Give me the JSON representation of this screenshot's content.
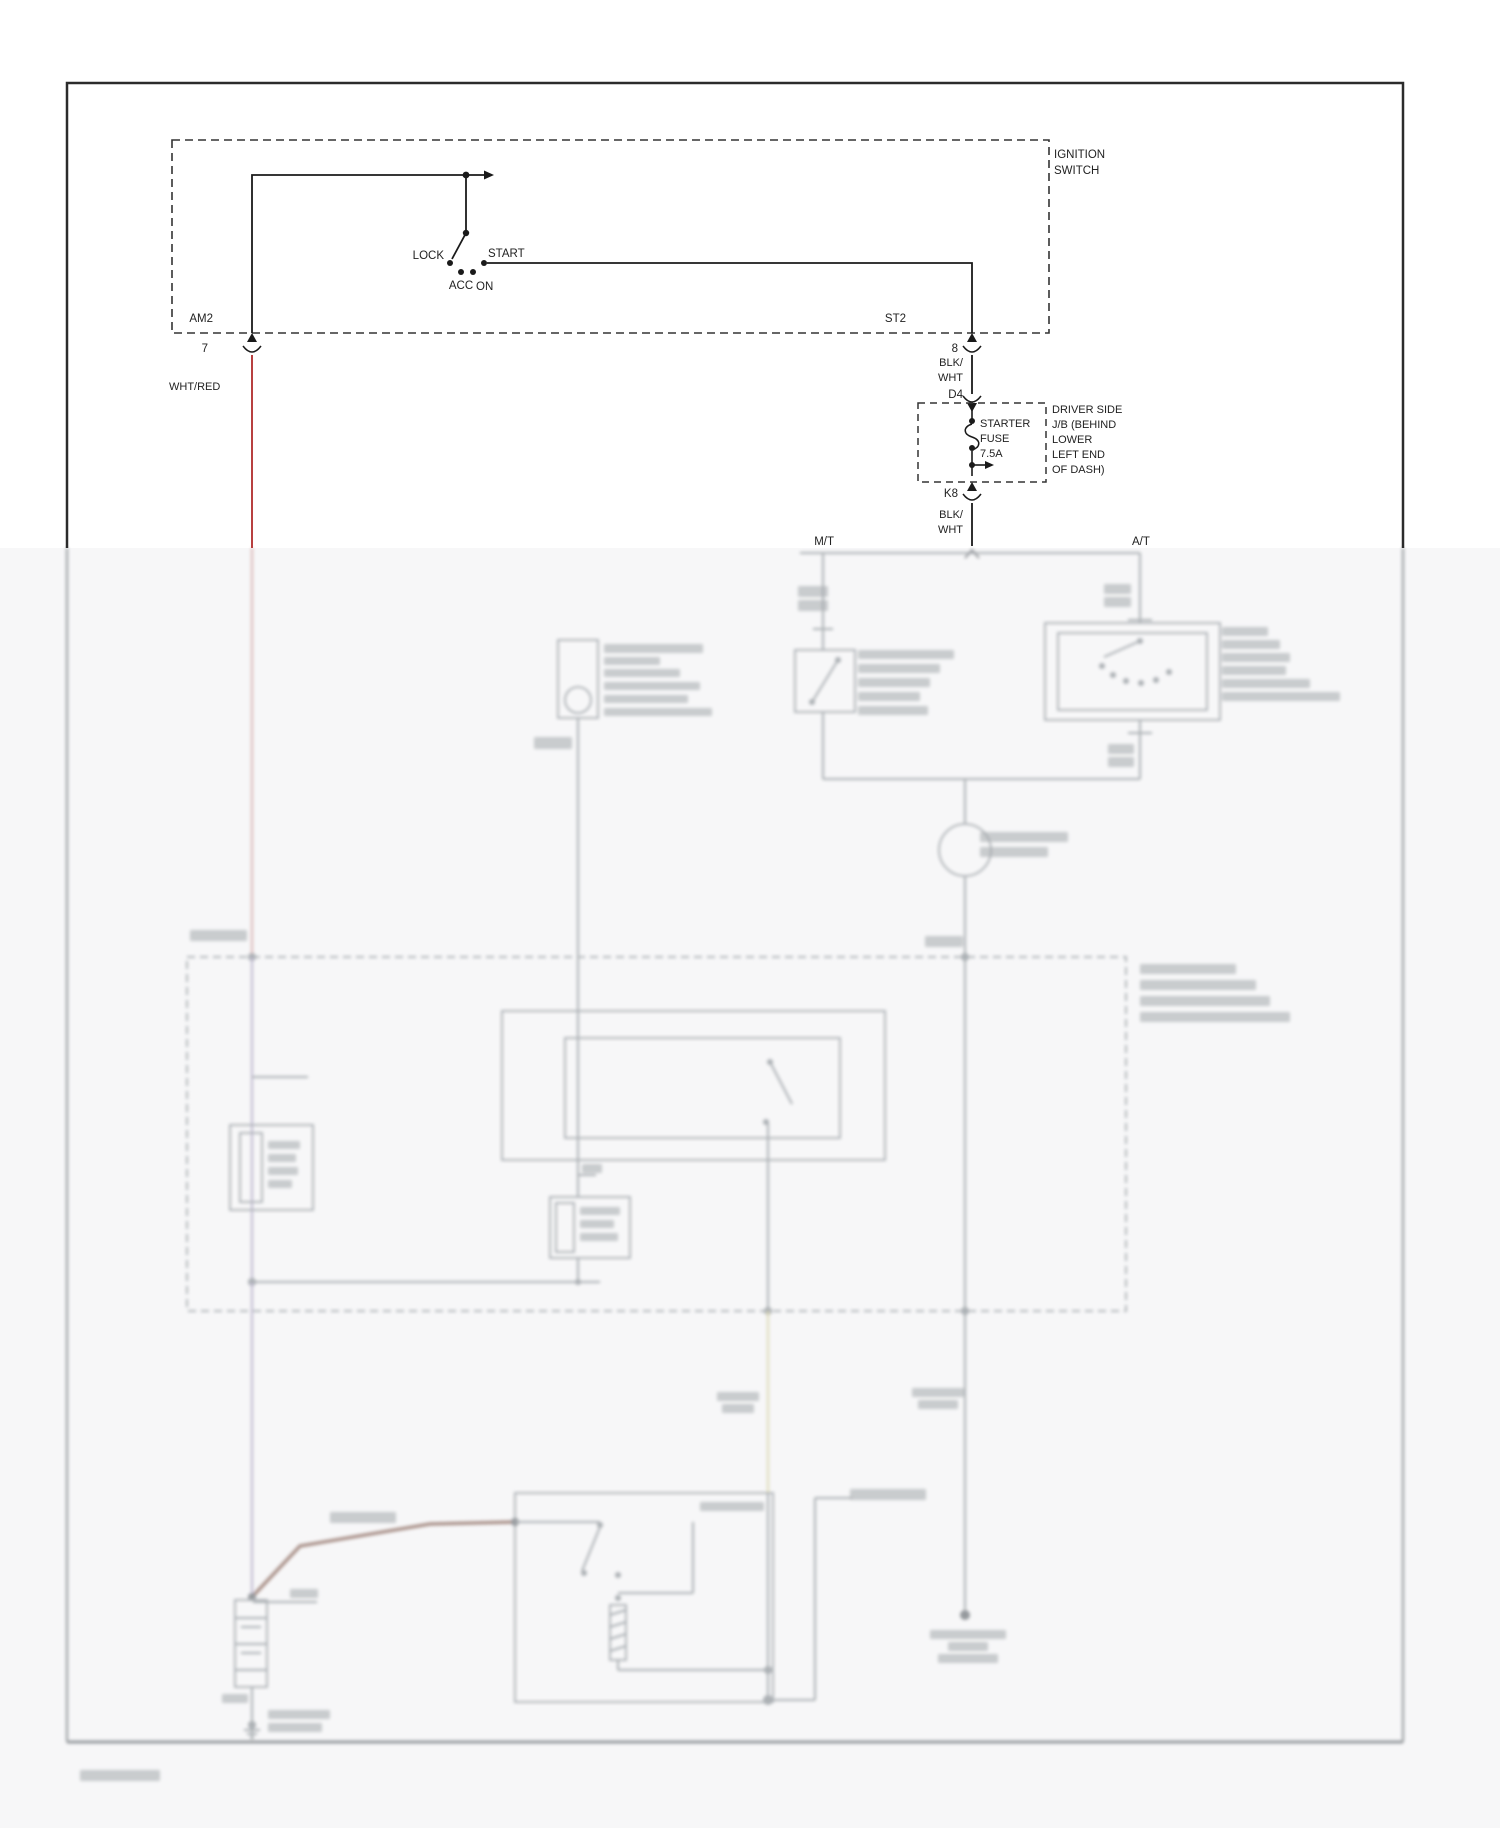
{
  "page": {
    "kind": "wiring-diagram",
    "background": "#ffffff",
    "faded_zone_bg": "#f7f7f8",
    "border_color": "#2b2b2b"
  },
  "diagram": {
    "accent_wire_red": "#b84040",
    "labels": {
      "ignition_line1": "IGNITION",
      "ignition_line2": "SWITCH",
      "lock": "LOCK",
      "acc": "ACC",
      "on": "ON",
      "start": "START",
      "am2": "AM2",
      "pin7": "7",
      "wht_red": "WHT/RED",
      "st2": "ST2",
      "pin8": "8",
      "blk1a": "BLK/",
      "blk1b": "WHT",
      "d4": "D4",
      "fuse_line1": "STARTER",
      "fuse_line2": "FUSE",
      "fuse_line3": "7.5A",
      "jb_line1": "DRIVER SIDE",
      "jb_line2": "J/B (BEHIND",
      "jb_line3": "LOWER",
      "jb_line4": "LEFT END",
      "jb_line5": "OF DASH)",
      "k8": "K8",
      "blk2a": "BLK/",
      "blk2b": "WHT",
      "mt": "M/T",
      "at": "A/T"
    }
  },
  "faded_sketch": {
    "base_stroke": "#7f868c",
    "bar_fill": "#6f767c",
    "colors": {
      "pink": "#c98f8f",
      "lav": "#9b92b5",
      "yel": "#cfc98f",
      "brown": "#7d564a",
      "dark": "#5a6066"
    },
    "items": [
      {
        "t": "l",
        "x1": 800,
        "y1": 553,
        "x2": 1140,
        "y2": 553
      },
      {
        "t": "p",
        "d": "M965,558 l7,-8 l7,8",
        "c": "dark"
      },
      {
        "t": "l",
        "x1": 823,
        "y1": 553,
        "x2": 823,
        "y2": 650
      },
      {
        "t": "l",
        "x1": 813,
        "y1": 629,
        "x2": 833,
        "y2": 629
      },
      {
        "t": "b",
        "x": 798,
        "y": 586,
        "w": 30,
        "h": 11
      },
      {
        "t": "b",
        "x": 798,
        "y": 600,
        "w": 30,
        "h": 11
      },
      {
        "t": "r",
        "x": 795,
        "y": 650,
        "w": 60,
        "h": 62
      },
      {
        "t": "l",
        "x1": 838,
        "y1": 660,
        "x2": 812,
        "y2": 702
      },
      {
        "t": "d",
        "cx": 838,
        "cy": 660,
        "r": 3
      },
      {
        "t": "d",
        "cx": 812,
        "cy": 702,
        "r": 3
      },
      {
        "t": "l",
        "x1": 823,
        "y1": 712,
        "x2": 823,
        "y2": 779
      },
      {
        "t": "b",
        "x": 858,
        "y": 650,
        "w": 96,
        "h": 9
      },
      {
        "t": "b",
        "x": 858,
        "y": 664,
        "w": 82,
        "h": 9
      },
      {
        "t": "b",
        "x": 858,
        "y": 678,
        "w": 72,
        "h": 9
      },
      {
        "t": "b",
        "x": 858,
        "y": 692,
        "w": 62,
        "h": 9
      },
      {
        "t": "b",
        "x": 858,
        "y": 706,
        "w": 70,
        "h": 9
      },
      {
        "t": "l",
        "x1": 1140,
        "y1": 553,
        "x2": 1140,
        "y2": 623
      },
      {
        "t": "b",
        "x": 1104,
        "y": 584,
        "w": 27,
        "h": 10
      },
      {
        "t": "b",
        "x": 1104,
        "y": 597,
        "w": 27,
        "h": 10
      },
      {
        "t": "l",
        "x1": 1128,
        "y1": 620,
        "x2": 1152,
        "y2": 620
      },
      {
        "t": "r",
        "x": 1045,
        "y": 623,
        "w": 175,
        "h": 97
      },
      {
        "t": "r",
        "x": 1058,
        "y": 633,
        "w": 149,
        "h": 77
      },
      {
        "t": "l",
        "x1": 1140,
        "y1": 641,
        "x2": 1104,
        "y2": 657
      },
      {
        "t": "d",
        "cx": 1140,
        "cy": 641,
        "r": 3
      },
      {
        "t": "d",
        "cx": 1102,
        "cy": 666,
        "r": 3
      },
      {
        "t": "d",
        "cx": 1113,
        "cy": 675,
        "r": 3
      },
      {
        "t": "d",
        "cx": 1126,
        "cy": 681,
        "r": 3
      },
      {
        "t": "d",
        "cx": 1141,
        "cy": 683,
        "r": 3
      },
      {
        "t": "d",
        "cx": 1156,
        "cy": 680,
        "r": 3
      },
      {
        "t": "d",
        "cx": 1169,
        "cy": 672,
        "r": 3
      },
      {
        "t": "l",
        "x1": 1140,
        "y1": 720,
        "x2": 1140,
        "y2": 779
      },
      {
        "t": "l",
        "x1": 1128,
        "y1": 733,
        "x2": 1152,
        "y2": 733
      },
      {
        "t": "b",
        "x": 1108,
        "y": 744,
        "w": 26,
        "h": 10
      },
      {
        "t": "b",
        "x": 1108,
        "y": 757,
        "w": 26,
        "h": 10
      },
      {
        "t": "b",
        "x": 1222,
        "y": 627,
        "w": 46,
        "h": 9
      },
      {
        "t": "b",
        "x": 1222,
        "y": 640,
        "w": 58,
        "h": 9
      },
      {
        "t": "b",
        "x": 1222,
        "y": 653,
        "w": 68,
        "h": 9
      },
      {
        "t": "b",
        "x": 1222,
        "y": 666,
        "w": 64,
        "h": 9
      },
      {
        "t": "b",
        "x": 1222,
        "y": 679,
        "w": 88,
        "h": 9
      },
      {
        "t": "b",
        "x": 1222,
        "y": 692,
        "w": 118,
        "h": 9
      },
      {
        "t": "l",
        "x1": 823,
        "y1": 779,
        "x2": 1140,
        "y2": 779
      },
      {
        "t": "l",
        "x1": 965,
        "y1": 779,
        "x2": 965,
        "y2": 824
      },
      {
        "t": "c",
        "cx": 965,
        "cy": 850,
        "r": 26
      },
      {
        "t": "b",
        "x": 980,
        "y": 832,
        "w": 88,
        "h": 10
      },
      {
        "t": "b",
        "x": 980,
        "y": 847,
        "w": 68,
        "h": 10
      },
      {
        "t": "l",
        "x1": 965,
        "y1": 876,
        "x2": 965,
        "y2": 957
      },
      {
        "t": "d",
        "cx": 965,
        "cy": 957,
        "r": 4
      },
      {
        "t": "b",
        "x": 925,
        "y": 936,
        "w": 38,
        "h": 11
      },
      {
        "t": "r",
        "x": 187,
        "y": 957,
        "w": 939,
        "h": 354,
        "dash": true
      },
      {
        "t": "b",
        "x": 190,
        "y": 930,
        "w": 57,
        "h": 11
      },
      {
        "t": "l",
        "x1": 252,
        "y1": 548,
        "x2": 252,
        "y2": 957,
        "c": "pink"
      },
      {
        "t": "d",
        "cx": 252,
        "cy": 957,
        "r": 4
      },
      {
        "t": "l",
        "x1": 252,
        "y1": 957,
        "x2": 252,
        "y2": 1282,
        "c": "lav"
      },
      {
        "t": "d",
        "cx": 252,
        "cy": 1282,
        "r": 4
      },
      {
        "t": "l",
        "x1": 252,
        "y1": 1282,
        "x2": 252,
        "y2": 1597,
        "c": "lav"
      },
      {
        "t": "l",
        "x1": 252,
        "y1": 1077,
        "x2": 308,
        "y2": 1077
      },
      {
        "t": "r",
        "x": 230,
        "y": 1125,
        "w": 83,
        "h": 85
      },
      {
        "t": "r",
        "x": 240,
        "y": 1133,
        "w": 22,
        "h": 69
      },
      {
        "t": "b",
        "x": 268,
        "y": 1141,
        "w": 32,
        "h": 8
      },
      {
        "t": "b",
        "x": 268,
        "y": 1154,
        "w": 28,
        "h": 8
      },
      {
        "t": "b",
        "x": 268,
        "y": 1167,
        "w": 30,
        "h": 8
      },
      {
        "t": "b",
        "x": 268,
        "y": 1180,
        "w": 24,
        "h": 8
      },
      {
        "t": "r",
        "x": 558,
        "y": 640,
        "w": 40,
        "h": 78
      },
      {
        "t": "c",
        "cx": 578,
        "cy": 700,
        "r": 13
      },
      {
        "t": "b",
        "x": 604,
        "y": 644,
        "w": 99,
        "h": 9
      },
      {
        "t": "b",
        "x": 604,
        "y": 657,
        "w": 56,
        "h": 8
      },
      {
        "t": "b",
        "x": 604,
        "y": 669,
        "w": 76,
        "h": 8
      },
      {
        "t": "b",
        "x": 604,
        "y": 682,
        "w": 96,
        "h": 8
      },
      {
        "t": "b",
        "x": 604,
        "y": 695,
        "w": 84,
        "h": 8
      },
      {
        "t": "b",
        "x": 604,
        "y": 708,
        "w": 108,
        "h": 8
      },
      {
        "t": "b",
        "x": 534,
        "y": 737,
        "w": 38,
        "h": 12
      },
      {
        "t": "l",
        "x1": 578,
        "y1": 718,
        "x2": 578,
        "y2": 1197
      },
      {
        "t": "l",
        "x1": 578,
        "y1": 1175,
        "x2": 596,
        "y2": 1175
      },
      {
        "t": "b",
        "x": 582,
        "y": 1164,
        "w": 20,
        "h": 9
      },
      {
        "t": "r",
        "x": 502,
        "y": 1011,
        "w": 383,
        "h": 149
      },
      {
        "t": "r",
        "x": 565,
        "y": 1038,
        "w": 275,
        "h": 100
      },
      {
        "t": "d",
        "cx": 770,
        "cy": 1062,
        "r": 3
      },
      {
        "t": "l",
        "x1": 770,
        "y1": 1062,
        "x2": 792,
        "y2": 1104
      },
      {
        "t": "d",
        "cx": 766,
        "cy": 1122,
        "r": 3
      },
      {
        "t": "l",
        "x1": 768,
        "y1": 1122,
        "x2": 768,
        "y2": 1311
      },
      {
        "t": "d",
        "cx": 768,
        "cy": 1311,
        "r": 4
      },
      {
        "t": "l",
        "x1": 768,
        "y1": 1311,
        "x2": 768,
        "y2": 1493,
        "c": "yel"
      },
      {
        "t": "b",
        "x": 717,
        "y": 1392,
        "w": 42,
        "h": 9
      },
      {
        "t": "b",
        "x": 722,
        "y": 1404,
        "w": 32,
        "h": 9
      },
      {
        "t": "r",
        "x": 550,
        "y": 1197,
        "w": 80,
        "h": 61
      },
      {
        "t": "r",
        "x": 556,
        "y": 1203,
        "w": 18,
        "h": 49
      },
      {
        "t": "b",
        "x": 580,
        "y": 1207,
        "w": 40,
        "h": 8
      },
      {
        "t": "b",
        "x": 580,
        "y": 1220,
        "w": 34,
        "h": 8
      },
      {
        "t": "b",
        "x": 580,
        "y": 1233,
        "w": 38,
        "h": 8
      },
      {
        "t": "l",
        "x1": 578,
        "y1": 1258,
        "x2": 578,
        "y2": 1282
      },
      {
        "t": "l",
        "x1": 252,
        "y1": 1282,
        "x2": 600,
        "y2": 1282
      },
      {
        "t": "d",
        "cx": 578,
        "cy": 1282,
        "r": 3
      },
      {
        "t": "l",
        "x1": 965,
        "y1": 957,
        "x2": 965,
        "y2": 1311
      },
      {
        "t": "d",
        "cx": 965,
        "cy": 1311,
        "r": 4
      },
      {
        "t": "l",
        "x1": 965,
        "y1": 1311,
        "x2": 965,
        "y2": 1610
      },
      {
        "t": "d",
        "cx": 965,
        "cy": 1615,
        "r": 5,
        "c": "dark"
      },
      {
        "t": "b",
        "x": 912,
        "y": 1388,
        "w": 52,
        "h": 9
      },
      {
        "t": "b",
        "x": 918,
        "y": 1400,
        "w": 40,
        "h": 9
      },
      {
        "t": "b",
        "x": 930,
        "y": 1630,
        "w": 76,
        "h": 9
      },
      {
        "t": "b",
        "x": 948,
        "y": 1642,
        "w": 40,
        "h": 9
      },
      {
        "t": "b",
        "x": 938,
        "y": 1654,
        "w": 60,
        "h": 9
      },
      {
        "t": "b",
        "x": 1140,
        "y": 964,
        "w": 96,
        "h": 10
      },
      {
        "t": "b",
        "x": 1140,
        "y": 980,
        "w": 116,
        "h": 10
      },
      {
        "t": "b",
        "x": 1140,
        "y": 996,
        "w": 130,
        "h": 10
      },
      {
        "t": "b",
        "x": 1140,
        "y": 1012,
        "w": 150,
        "h": 10
      },
      {
        "t": "p",
        "d": "M252,1597 L300,1546 L430,1524 L515,1522",
        "c": "brown",
        "w": 3.5
      },
      {
        "t": "b",
        "x": 330,
        "y": 1512,
        "w": 66,
        "h": 11
      },
      {
        "t": "d",
        "cx": 252,
        "cy": 1597,
        "r": 4,
        "c": "dark"
      },
      {
        "t": "l",
        "x1": 253,
        "y1": 1602,
        "x2": 317,
        "y2": 1602
      },
      {
        "t": "b",
        "x": 290,
        "y": 1589,
        "w": 28,
        "h": 9
      },
      {
        "t": "r",
        "x": 235,
        "y": 1600,
        "w": 32,
        "h": 87
      },
      {
        "t": "l",
        "x1": 235,
        "y1": 1618,
        "x2": 267,
        "y2": 1618
      },
      {
        "t": "l",
        "x1": 241,
        "y1": 1627,
        "x2": 261,
        "y2": 1627
      },
      {
        "t": "l",
        "x1": 235,
        "y1": 1644,
        "x2": 267,
        "y2": 1644
      },
      {
        "t": "l",
        "x1": 241,
        "y1": 1653,
        "x2": 261,
        "y2": 1653
      },
      {
        "t": "l",
        "x1": 235,
        "y1": 1670,
        "x2": 267,
        "y2": 1670
      },
      {
        "t": "b",
        "x": 222,
        "y": 1694,
        "w": 26,
        "h": 9
      },
      {
        "t": "l",
        "x1": 252,
        "y1": 1687,
        "x2": 252,
        "y2": 1738
      },
      {
        "t": "d",
        "cx": 252,
        "cy": 1725,
        "r": 4
      },
      {
        "t": "b",
        "x": 268,
        "y": 1710,
        "w": 62,
        "h": 9
      },
      {
        "t": "b",
        "x": 268,
        "y": 1723,
        "w": 54,
        "h": 9
      },
      {
        "t": "l",
        "x1": 244,
        "y1": 1730,
        "x2": 260,
        "y2": 1730
      },
      {
        "t": "l",
        "x1": 247,
        "y1": 1734,
        "x2": 257,
        "y2": 1734
      },
      {
        "t": "l",
        "x1": 250,
        "y1": 1738,
        "x2": 254,
        "y2": 1738
      },
      {
        "t": "r",
        "x": 515,
        "y": 1493,
        "w": 258,
        "h": 209
      },
      {
        "t": "d",
        "cx": 515,
        "cy": 1522,
        "r": 4,
        "c": "dark"
      },
      {
        "t": "l",
        "x1": 515,
        "y1": 1522,
        "x2": 600,
        "y2": 1522
      },
      {
        "t": "l",
        "x1": 600,
        "y1": 1527,
        "x2": 582,
        "y2": 1571
      },
      {
        "t": "d",
        "cx": 600,
        "cy": 1525,
        "r": 3
      },
      {
        "t": "d",
        "cx": 584,
        "cy": 1573,
        "r": 3
      },
      {
        "t": "l",
        "x1": 693,
        "y1": 1522,
        "x2": 693,
        "y2": 1593
      },
      {
        "t": "l",
        "x1": 618,
        "y1": 1593,
        "x2": 693,
        "y2": 1593
      },
      {
        "t": "d",
        "cx": 618,
        "cy": 1575,
        "r": 3
      },
      {
        "t": "d",
        "cx": 618,
        "cy": 1598,
        "r": 3
      },
      {
        "t": "r",
        "x": 610,
        "y": 1605,
        "w": 16,
        "h": 55
      },
      {
        "t": "l",
        "x1": 610,
        "y1": 1615,
        "x2": 626,
        "y2": 1610
      },
      {
        "t": "l",
        "x1": 610,
        "y1": 1627,
        "x2": 626,
        "y2": 1622
      },
      {
        "t": "l",
        "x1": 610,
        "y1": 1639,
        "x2": 626,
        "y2": 1634
      },
      {
        "t": "l",
        "x1": 610,
        "y1": 1651,
        "x2": 626,
        "y2": 1646
      },
      {
        "t": "l",
        "x1": 618,
        "y1": 1660,
        "x2": 618,
        "y2": 1670
      },
      {
        "t": "l",
        "x1": 618,
        "y1": 1670,
        "x2": 768,
        "y2": 1670
      },
      {
        "t": "d",
        "cx": 768,
        "cy": 1670,
        "r": 4
      },
      {
        "t": "d",
        "cx": 768,
        "cy": 1700,
        "r": 5
      },
      {
        "t": "l",
        "x1": 768,
        "y1": 1493,
        "x2": 768,
        "y2": 1700
      },
      {
        "t": "l",
        "x1": 773,
        "y1": 1700,
        "x2": 815,
        "y2": 1700
      },
      {
        "t": "l",
        "x1": 815,
        "y1": 1498,
        "x2": 815,
        "y2": 1700
      },
      {
        "t": "l",
        "x1": 815,
        "y1": 1498,
        "x2": 852,
        "y2": 1498
      },
      {
        "t": "b",
        "x": 850,
        "y": 1489,
        "w": 76,
        "h": 11
      },
      {
        "t": "b",
        "x": 700,
        "y": 1502,
        "w": 64,
        "h": 9
      },
      {
        "t": "l",
        "x1": 67,
        "y1": 548,
        "x2": 67,
        "y2": 1742,
        "c": "dark"
      },
      {
        "t": "l",
        "x1": 1403,
        "y1": 548,
        "x2": 1403,
        "y2": 1742,
        "c": "dark"
      },
      {
        "t": "l",
        "x1": 67,
        "y1": 1742,
        "x2": 1403,
        "y2": 1742,
        "c": "dark",
        "w": 3
      },
      {
        "t": "b",
        "x": 80,
        "y": 1770,
        "w": 80,
        "h": 11
      }
    ]
  }
}
